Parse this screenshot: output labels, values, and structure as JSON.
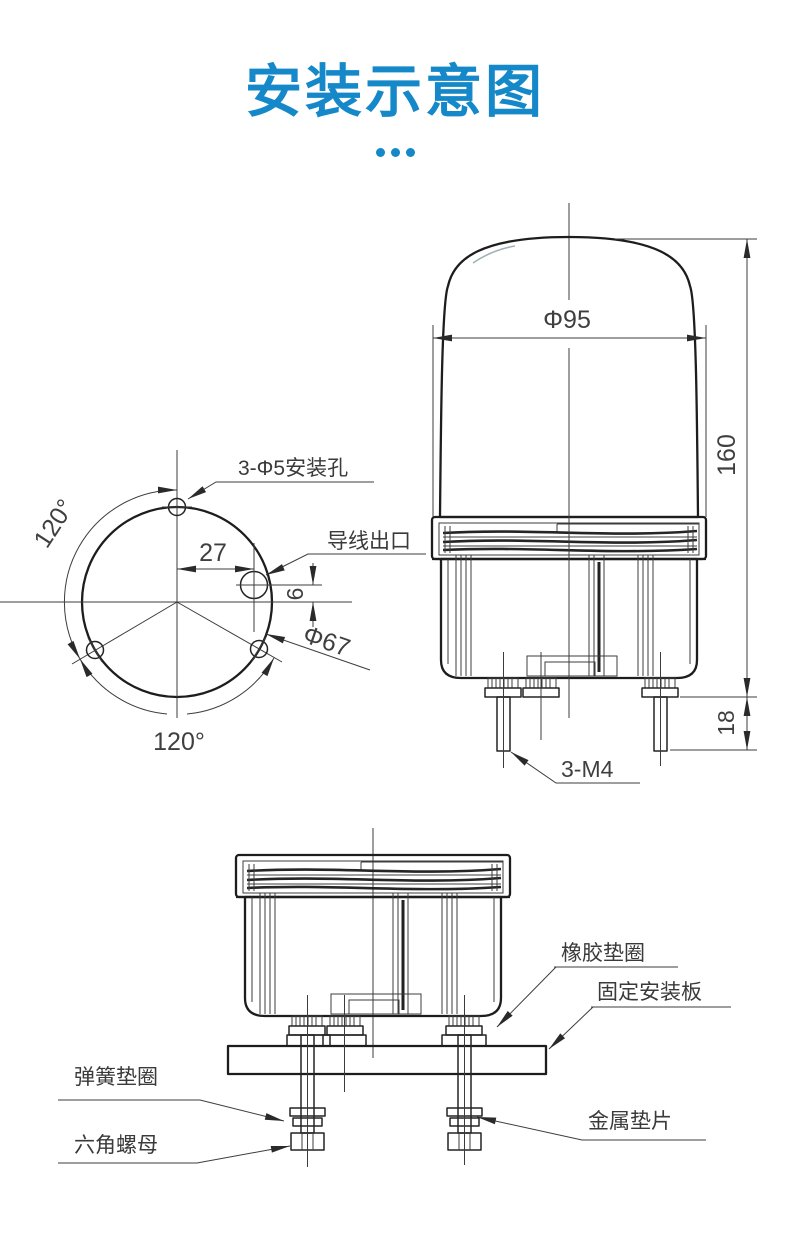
{
  "page": {
    "title": "安装示意图",
    "accent_color": "#1488c8",
    "background_color": "#ffffff"
  },
  "front_view": {
    "dim_diameter": "Φ95",
    "dim_height": "160",
    "dim_stud_length": "18",
    "label_studs": "3-M4"
  },
  "hole_layout_view": {
    "label_mount_holes": "3-Φ5安装孔",
    "label_wire_outlet": "导线出口",
    "dim_offset_x": "27",
    "dim_offset_y": "6",
    "dim_bolt_circle": "Φ67",
    "angle_left": "120°",
    "angle_bottom": "120°"
  },
  "installation_view": {
    "label_rubber_washer": "橡胶垫圈",
    "label_mounting_plate": "固定安装板",
    "label_spring_washer": "弹簧垫圈",
    "label_hex_nut": "六角螺母",
    "label_metal_shim": "金属垫片"
  }
}
